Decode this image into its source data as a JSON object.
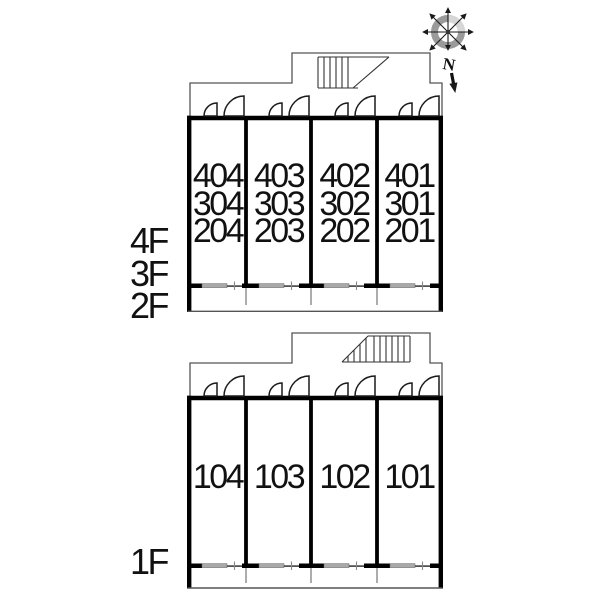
{
  "compass": {
    "north_label": "N"
  },
  "upper_plan": {
    "floor_labels": [
      "4F",
      "3F",
      "2F"
    ],
    "units": [
      {
        "lines": [
          "404",
          "304",
          "204"
        ]
      },
      {
        "lines": [
          "403",
          "303",
          "203"
        ]
      },
      {
        "lines": [
          "402",
          "302",
          "202"
        ]
      },
      {
        "lines": [
          "401",
          "301",
          "201"
        ]
      }
    ]
  },
  "lower_plan": {
    "floor_labels": [
      "1F"
    ],
    "units": [
      {
        "lines": [
          "104"
        ]
      },
      {
        "lines": [
          "103"
        ]
      },
      {
        "lines": [
          "102"
        ]
      },
      {
        "lines": [
          "101"
        ]
      }
    ]
  },
  "colors": {
    "wall": "#000000",
    "outline": "#555555",
    "window-gray": "#a9a9a9",
    "text": "#111111",
    "compass-ring": "#9a9a9a",
    "compass-ring-light": "#d7d7d7"
  }
}
